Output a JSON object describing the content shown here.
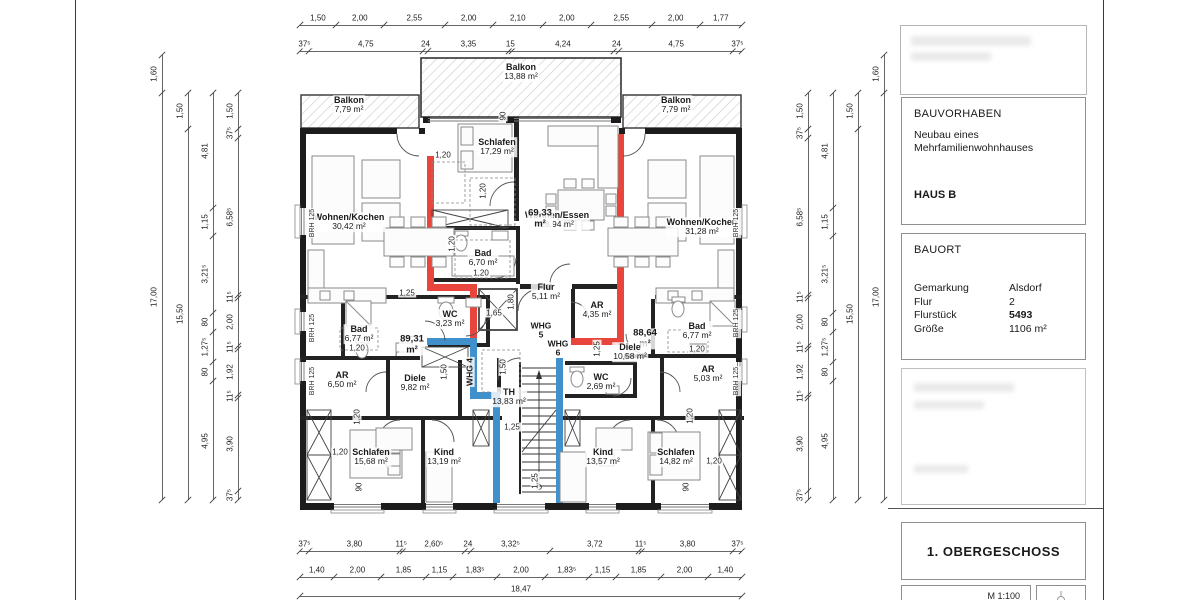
{
  "panel": {
    "bauvorhaben": {
      "title": "BAUVORHABEN",
      "line1": "Neubau eines",
      "line2": "Mehrfamilienwohnhauses",
      "haus": "HAUS B"
    },
    "bauort": {
      "title": "BAUORT",
      "rows": [
        {
          "k": "Gemarkung",
          "v": "Alsdorf",
          "bold": false
        },
        {
          "k": "Flur",
          "v": "2",
          "bold": false
        },
        {
          "k": "Flurstück",
          "v": "5493",
          "bold": true
        },
        {
          "k": "Größe",
          "v": "1106 m²",
          "bold": false
        }
      ]
    },
    "drawing_title": "1. OBERGESCHOSS",
    "scale_label": "M 1:100"
  },
  "plan": {
    "labels": [
      {
        "cls": "room",
        "n": "Balkon",
        "a": "13,88 m²",
        "x": 521,
        "y": 72
      },
      {
        "cls": "room",
        "n": "Balkon",
        "a": "7,79 m²",
        "x": 349,
        "y": 105
      },
      {
        "cls": "room",
        "n": "Balkon",
        "a": "7,79 m²",
        "x": 676,
        "y": 105
      },
      {
        "cls": "room",
        "n": "Schlafen",
        "a": "17,29 m²",
        "x": 497,
        "y": 147
      },
      {
        "cls": "room",
        "n": "Wohnen/Essen",
        "a": "28,94 m²",
        "x": 557,
        "y": 220
      },
      {
        "cls": "room",
        "n": "Wohnen/Kochen",
        "a": "30,42 m²",
        "x": 349,
        "y": 222
      },
      {
        "cls": "room",
        "n": "Wohnen/Kochen",
        "a": "31,28 m²",
        "x": 702,
        "y": 227
      },
      {
        "cls": "room",
        "n": "Bad",
        "a": "6,70 m²",
        "x": 483,
        "y": 258
      },
      {
        "cls": "room",
        "n": "Flur",
        "a": "5,11 m²",
        "x": 546,
        "y": 292
      },
      {
        "cls": "room",
        "n": "AR",
        "a": "4,35 m²",
        "x": 597,
        "y": 310
      },
      {
        "cls": "room",
        "n": "WC",
        "a": "3,23 m²",
        "x": 450,
        "y": 319
      },
      {
        "cls": "room",
        "n": "Bad",
        "a": "6,77 m²",
        "x": 359,
        "y": 334
      },
      {
        "cls": "room",
        "n": "Bad",
        "a": "6,77 m²",
        "x": 697,
        "y": 331
      },
      {
        "cls": "total",
        "n": "69,33",
        "a": "m²",
        "x": 540,
        "y": 219
      },
      {
        "cls": "total",
        "n": "89,31",
        "a": "m²",
        "x": 412,
        "y": 345
      },
      {
        "cls": "total",
        "n": "88,64",
        "a": "m²",
        "x": 645,
        "y": 339
      },
      {
        "cls": "room",
        "n": "Diele",
        "a": "9,82 m²",
        "x": 415,
        "y": 383
      },
      {
        "cls": "room",
        "n": "Diele",
        "a": "10,58 m²",
        "x": 630,
        "y": 352
      },
      {
        "cls": "room",
        "n": "AR",
        "a": "6,50 m²",
        "x": 342,
        "y": 380
      },
      {
        "cls": "room",
        "n": "AR",
        "a": "5,03 m²",
        "x": 708,
        "y": 374
      },
      {
        "cls": "room",
        "n": "WC",
        "a": "2,69 m²",
        "x": 601,
        "y": 382
      },
      {
        "cls": "room",
        "n": "TH",
        "a": "13,83 m²",
        "x": 509,
        "y": 397
      },
      {
        "cls": "room",
        "n": "Schlafen",
        "a": "15,68 m²",
        "x": 371,
        "y": 457
      },
      {
        "cls": "room",
        "n": "Kind",
        "a": "13,19 m²",
        "x": 444,
        "y": 457
      },
      {
        "cls": "room",
        "n": "Kind",
        "a": "13,57 m²",
        "x": 603,
        "y": 457
      },
      {
        "cls": "room",
        "n": "Schlafen",
        "a": "14,82 m²",
        "x": 676,
        "y": 457
      },
      {
        "cls": "whg",
        "n": "WHG",
        "a": "5",
        "x": 541,
        "y": 330
      },
      {
        "cls": "whg",
        "n": "WHG",
        "a": "6",
        "x": 558,
        "y": 348
      },
      {
        "cls": "whg",
        "n": "WHG 4",
        "x": 470,
        "y": 372,
        "v": true
      },
      {
        "cls": "brh",
        "n": "BRH 125",
        "x": 313,
        "y": 223,
        "v": true
      },
      {
        "cls": "brh",
        "n": "BRH 125",
        "x": 313,
        "y": 328,
        "v": true
      },
      {
        "cls": "brh",
        "n": "BRH 125",
        "x": 313,
        "y": 381,
        "v": true
      },
      {
        "cls": "brh",
        "n": "BRH 125",
        "x": 737,
        "y": 223,
        "v": true
      },
      {
        "cls": "brh",
        "n": "BRH 125",
        "x": 737,
        "y": 323,
        "v": true
      },
      {
        "cls": "brh",
        "n": "BRH 125",
        "x": 737,
        "y": 381,
        "v": true
      }
    ],
    "small_dims": [
      {
        "t": "1,20",
        "x": 443,
        "y": 155
      },
      {
        "t": "90",
        "x": 503,
        "y": 116,
        "v": true
      },
      {
        "t": "1,20",
        "x": 483,
        "y": 191,
        "v": true
      },
      {
        "t": "1,20",
        "x": 452,
        "y": 244,
        "v": true
      },
      {
        "t": "1,20",
        "x": 481,
        "y": 273
      },
      {
        "t": "1,25",
        "x": 407,
        "y": 293
      },
      {
        "t": "1,65",
        "x": 494,
        "y": 313
      },
      {
        "t": "1,80",
        "x": 511,
        "y": 302,
        "v": true
      },
      {
        "t": "1,20",
        "x": 357,
        "y": 348
      },
      {
        "t": "1,50",
        "x": 444,
        "y": 372,
        "v": true
      },
      {
        "t": "1,25",
        "x": 597,
        "y": 349,
        "v": true
      },
      {
        "t": "1,50",
        "x": 503,
        "y": 367,
        "v": true
      },
      {
        "t": "1,25",
        "x": 512,
        "y": 427
      },
      {
        "t": "1,25",
        "x": 535,
        "y": 481,
        "v": true
      },
      {
        "t": "1,20",
        "x": 357,
        "y": 417,
        "v": true
      },
      {
        "t": "1,20",
        "x": 340,
        "y": 452
      },
      {
        "t": "90",
        "x": 359,
        "y": 487,
        "v": true
      },
      {
        "t": "1,20",
        "x": 690,
        "y": 416,
        "v": true
      },
      {
        "t": "1,20",
        "x": 714,
        "y": 461
      },
      {
        "t": "90",
        "x": 686,
        "y": 487,
        "v": true
      },
      {
        "t": "1,20",
        "x": 697,
        "y": 349
      }
    ],
    "chains": [
      {
        "o": "h",
        "x": 300,
        "y": 25,
        "items": [
          {
            "m": 1.5,
            "l": "1,50"
          },
          {
            "m": 2.0,
            "l": "2,00"
          },
          {
            "m": 2.55,
            "l": "2,55"
          },
          {
            "m": 2.0,
            "l": "2,00"
          },
          {
            "m": 2.1,
            "l": "2,10"
          },
          {
            "m": 2.0,
            "l": "2,00"
          },
          {
            "m": 2.55,
            "l": "2,55"
          },
          {
            "m": 2.0,
            "l": "2,00"
          },
          {
            "m": 1.77,
            "l": "1,77"
          }
        ]
      },
      {
        "o": "h",
        "x": 300,
        "y": 51,
        "items": [
          {
            "m": 0.375,
            "l": "37⁵"
          },
          {
            "m": 4.75,
            "l": "4,75"
          },
          {
            "m": 0.24,
            "l": "24"
          },
          {
            "m": 3.35,
            "l": "3,35"
          },
          {
            "m": 0.15,
            "l": "15"
          },
          {
            "m": 4.24,
            "l": "4,24"
          },
          {
            "m": 0.24,
            "l": "24"
          },
          {
            "m": 4.75,
            "l": "4,75"
          },
          {
            "m": 0.375,
            "l": "37⁵"
          }
        ]
      },
      {
        "o": "h",
        "x": 300,
        "y": 551,
        "items": [
          {
            "m": 0.375,
            "l": "37⁵"
          },
          {
            "m": 3.8,
            "l": "3,80"
          },
          {
            "m": 0.115,
            "l": "11⁵"
          },
          {
            "m": 2.605,
            "l": "2,60⁵"
          },
          {
            "m": 0.24,
            "l": "24"
          },
          {
            "m": 3.325,
            "l": "3,32⁵"
          },
          {
            "m": 3.72,
            "l": "3,72"
          },
          {
            "m": 0.115,
            "l": "11⁵"
          },
          {
            "m": 3.8,
            "l": "3,80"
          },
          {
            "m": 0.375,
            "l": "37⁵"
          }
        ]
      },
      {
        "o": "h",
        "x": 300,
        "y": 577,
        "items": [
          {
            "m": 1.4,
            "l": "1,40"
          },
          {
            "m": 2.0,
            "l": "2,00"
          },
          {
            "m": 1.85,
            "l": "1,85"
          },
          {
            "m": 1.15,
            "l": "1,15"
          },
          {
            "m": 1.835,
            "l": "1,83⁵"
          },
          {
            "m": 2.0,
            "l": "2,00"
          },
          {
            "m": 1.835,
            "l": "1,83⁵"
          },
          {
            "m": 1.15,
            "l": "1,15"
          },
          {
            "m": 1.85,
            "l": "1,85"
          },
          {
            "m": 2.0,
            "l": "2,00"
          },
          {
            "m": 1.4,
            "l": "1,40"
          }
        ]
      },
      {
        "o": "h",
        "x": 300,
        "y": 596,
        "items": [
          {
            "m": 18.47,
            "l": "18,47"
          }
        ]
      },
      {
        "o": "v",
        "x": 162,
        "y": 55,
        "items": [
          {
            "m": 1.6,
            "l": "1,60"
          },
          {
            "m": 17.0,
            "l": "17,00"
          }
        ]
      },
      {
        "o": "v",
        "x": 188,
        "y": 93,
        "items": [
          {
            "m": 1.5,
            "l": "1,50"
          },
          {
            "m": 15.5,
            "l": "15,50"
          }
        ]
      },
      {
        "o": "v",
        "x": 213,
        "y": 93,
        "items": [
          {
            "m": 4.81,
            "l": "4,81"
          },
          {
            "m": 1.15,
            "l": "1,15"
          },
          {
            "m": 3.215,
            "l": "3,21⁵"
          },
          {
            "m": 0.8,
            "l": "80"
          },
          {
            "m": 1.275,
            "l": "1,27⁵"
          },
          {
            "m": 0.8,
            "l": "80"
          },
          {
            "m": 4.95,
            "l": "4,95"
          }
        ]
      },
      {
        "o": "v",
        "x": 238,
        "y": 93,
        "items": [
          {
            "m": 1.5,
            "l": "1,50"
          },
          {
            "m": 0.375,
            "l": "37⁵"
          },
          {
            "m": 6.585,
            "l": "6,58⁵"
          },
          {
            "m": 0.115,
            "l": "11⁵"
          },
          {
            "m": 2.0,
            "l": "2,00"
          },
          {
            "m": 0.115,
            "l": "11⁵"
          },
          {
            "m": 1.92,
            "l": "1,92"
          },
          {
            "m": 0.115,
            "l": "11⁵"
          },
          {
            "m": 3.9,
            "l": "3,90"
          },
          {
            "m": 0.375,
            "l": "37⁵"
          }
        ]
      },
      {
        "o": "v",
        "x": 808,
        "y": 93,
        "items": [
          {
            "m": 1.5,
            "l": "1,50"
          },
          {
            "m": 0.375,
            "l": "37⁵"
          },
          {
            "m": 6.585,
            "l": "6,58⁵"
          },
          {
            "m": 0.115,
            "l": "11⁵"
          },
          {
            "m": 2.0,
            "l": "2,00"
          },
          {
            "m": 0.115,
            "l": "11⁵"
          },
          {
            "m": 1.92,
            "l": "1,92"
          },
          {
            "m": 0.115,
            "l": "11⁵"
          },
          {
            "m": 3.9,
            "l": "3,90"
          },
          {
            "m": 0.375,
            "l": "37⁵"
          }
        ]
      },
      {
        "o": "v",
        "x": 833,
        "y": 93,
        "items": [
          {
            "m": 4.81,
            "l": "4,81"
          },
          {
            "m": 1.15,
            "l": "1,15"
          },
          {
            "m": 3.215,
            "l": "3,21⁵"
          },
          {
            "m": 0.8,
            "l": "80"
          },
          {
            "m": 1.275,
            "l": "1,27⁵"
          },
          {
            "m": 0.8,
            "l": "80"
          },
          {
            "m": 4.95,
            "l": "4,95"
          }
        ]
      },
      {
        "o": "v",
        "x": 858,
        "y": 93,
        "items": [
          {
            "m": 1.5,
            "l": "1,50"
          },
          {
            "m": 15.5,
            "l": "15,50"
          }
        ]
      },
      {
        "o": "v",
        "x": 884,
        "y": 55,
        "items": [
          {
            "m": 1.6,
            "l": "1,60"
          },
          {
            "m": 17.0,
            "l": "17,00"
          }
        ]
      }
    ],
    "colors": {
      "new_wall_red": "#e8453c",
      "new_wall_blue": "#4090cc"
    }
  }
}
